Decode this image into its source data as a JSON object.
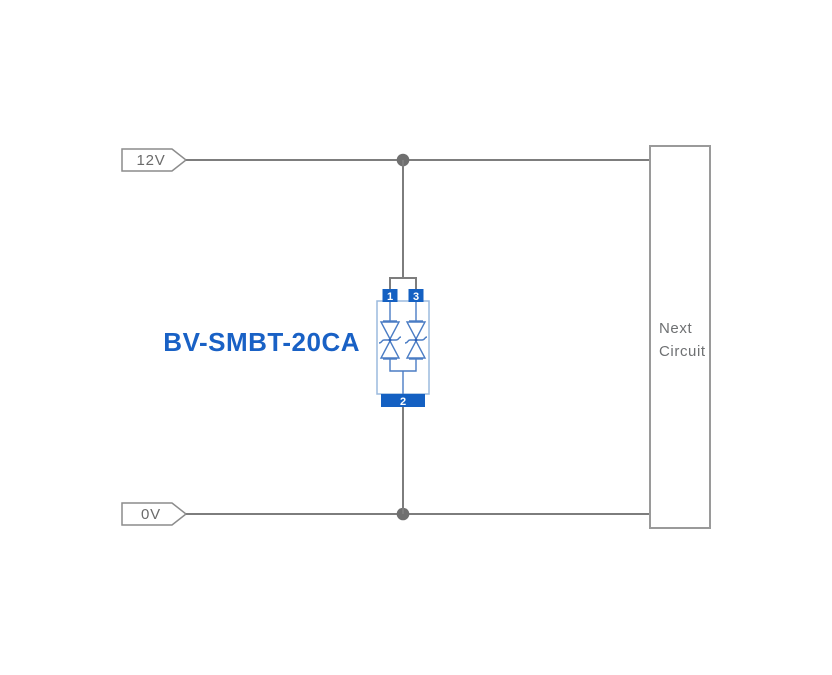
{
  "diagram": {
    "component_label": "BV-SMBT-20CA",
    "rails": {
      "top": {
        "label": "12V"
      },
      "bottom": {
        "label": "0V"
      }
    },
    "next_circuit": {
      "line1": "Next",
      "line2": "Circuit"
    },
    "component": {
      "type": "bidirectional-tvs-diode-array",
      "pin_top_left": "1",
      "pin_top_right": "3",
      "pin_bottom": "2"
    },
    "colors": {
      "background": "#ffffff",
      "wire": "#7d7d7d",
      "junction_dot": "#6f6f6f",
      "tag_border": "#8c8c8c",
      "tag_text": "#6b6b6b",
      "next_circuit_border": "#9a9a9a",
      "next_circuit_text": "#6e7072",
      "component_body_outline": "#9bbade",
      "component_symbol": "#4a7cc4",
      "pin_fill": "#1460c2",
      "pin_text": "#ffffff",
      "component_label_text": "#1961c5"
    }
  }
}
